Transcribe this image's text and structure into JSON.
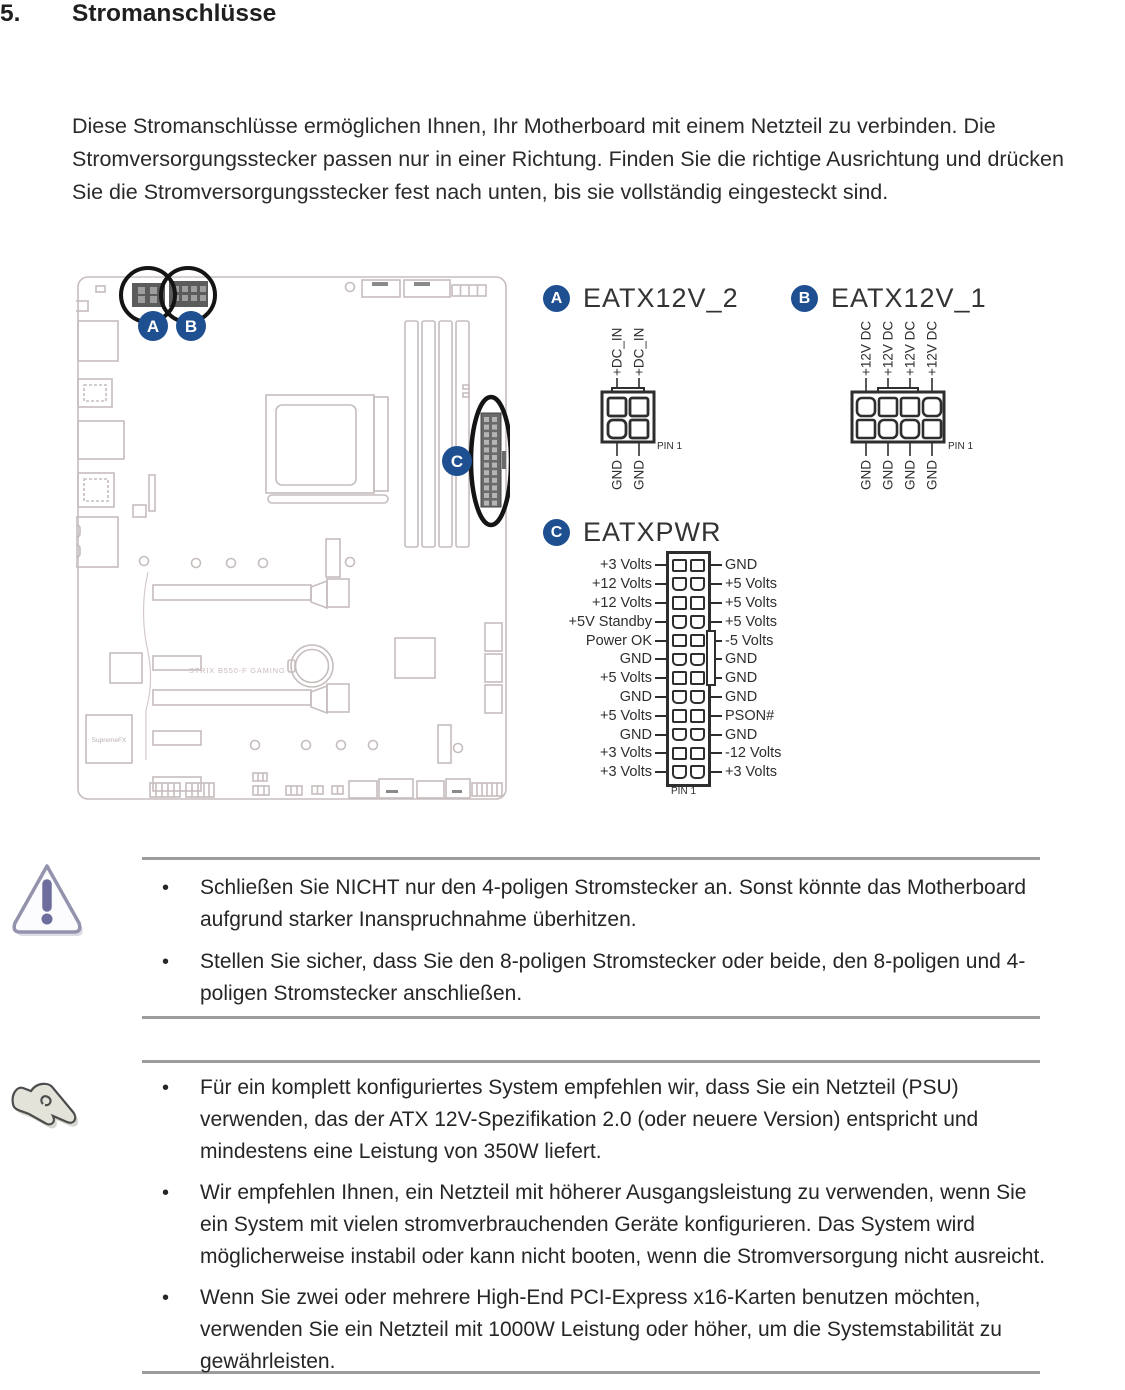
{
  "page": {
    "section_number": "5.",
    "section_title": "Stromanschlüsse",
    "intro": "Diese Stromanschlüsse ermöglichen Ihnen, Ihr Motherboard mit einem Netzteil zu verbinden. Die Stromversorgungsstecker passen nur in einer Richtung. Finden Sie die richtige Ausrichtung und drücken Sie die Stromversorgungsstecker fest nach unten, bis sie vollständig eingesteckt sind."
  },
  "board": {
    "model_label": "STRIX B550-F GAMING",
    "supremefx_label": "SupremeFX"
  },
  "connectors": {
    "a": {
      "badge": "A",
      "title": "EATX12V_2",
      "top_labels": [
        "+DC_IN",
        "+DC_IN"
      ],
      "bottom_labels": [
        "GND",
        "GND"
      ],
      "pin1": "PIN 1"
    },
    "b": {
      "badge": "B",
      "title": "EATX12V_1",
      "top_labels": [
        "+12V DC",
        "+12V DC",
        "+12V DC",
        "+12V DC"
      ],
      "bottom_labels": [
        "GND",
        "GND",
        "GND",
        "GND"
      ],
      "pin1": "PIN 1"
    },
    "c": {
      "badge": "C",
      "title": "EATXPWR",
      "left_labels": [
        "+3 Volts",
        "+12 Volts",
        "+12 Volts",
        "+5V Standby",
        "Power OK",
        "GND",
        "+5 Volts",
        "GND",
        "+5 Volts",
        "GND",
        "+3 Volts",
        "+3 Volts"
      ],
      "right_labels": [
        "GND",
        "+5 Volts",
        "+5 Volts",
        "+5 Volts",
        "-5 Volts",
        "GND",
        "GND",
        "GND",
        "PSON#",
        "GND",
        "-12 Volts",
        "+3 Volts"
      ],
      "pin1": "PIN 1"
    }
  },
  "warning": {
    "items": [
      "Schließen Sie NICHT nur den 4-poligen Stromstecker an. Sonst könnte das Motherboard aufgrund starker Inanspruchnahme überhitzen.",
      "Stellen Sie sicher, dass Sie den 8-poligen Stromstecker oder beide, den 8-poligen und 4-poligen Stromstecker anschließen."
    ]
  },
  "note": {
    "items": [
      "Für ein komplett konfiguriertes System empfehlen wir, dass Sie ein Netzteil (PSU) verwenden, das der ATX 12V-Spezifikation 2.0 (oder neuere Version) entspricht und mindestens eine Leistung von 350W liefert.",
      "Wir empfehlen Ihnen, ein Netzteil mit höherer Ausgangsleistung zu verwenden, wenn Sie ein System mit vielen stromverbrauchenden Geräte konfigurieren. Das System wird möglicherweise instabil oder kann nicht booten, wenn die Stromversorgung nicht ausreicht.",
      "Wenn Sie zwei oder mehrere High-End PCI-Express x16-Karten benutzen möchten, verwenden Sie ein Netzteil mit 1000W Leistung oder höher, um die Systemstabilität zu gewährleisten."
    ]
  },
  "colors": {
    "badge_blue": "#1D4F91",
    "text": "#262626",
    "rule_gray": "#9c9c9c",
    "warning_purple": "#6E6E9E"
  }
}
